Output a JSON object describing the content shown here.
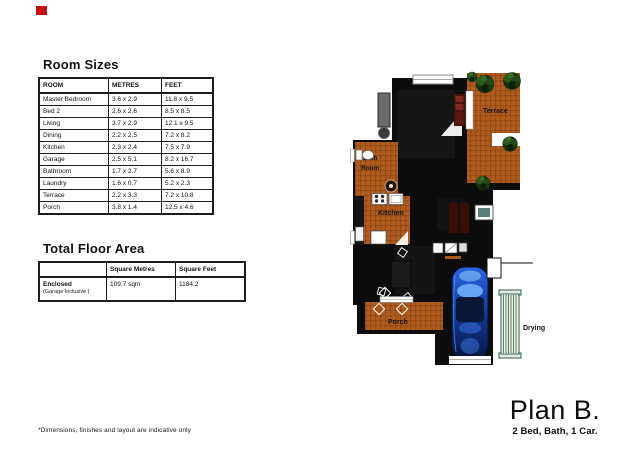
{
  "page": {
    "red_mark_color": "#c41010"
  },
  "room_sizes": {
    "title": "Room Sizes",
    "headers": [
      "ROOM",
      "METRES",
      "FEET"
    ],
    "rows": [
      [
        "Master Bedroom",
        "3.6 x 2.9",
        "11.8 x 9.5"
      ],
      [
        "Bed 2",
        "2.6 x 2.6",
        "8.5 x 8.5"
      ],
      [
        "Living",
        "3.7 x 2.9",
        "12.1 x 9.5"
      ],
      [
        "Dining",
        "2.2 x 2.5",
        "7.2 x 8.2"
      ],
      [
        "Kitchen",
        "2.3 x 2.4",
        "7.5 x 7.9"
      ],
      [
        "Garage",
        "2.5 x 5.1",
        "8.2 x 16.7"
      ],
      [
        "Bathroom",
        "1.7 x 2.7",
        "5.6 x 8.9"
      ],
      [
        "Laundry",
        "1.6 x 0.7",
        "5.2 x 2.3"
      ],
      [
        "Terrace",
        "2.2 x 3.3",
        "7.2 x 10.8"
      ],
      [
        "Porch",
        "3.8 x 1.4",
        "12.5 x 4.6"
      ]
    ]
  },
  "total_floor_area": {
    "title": "Total Floor Area",
    "headers": [
      "",
      "Square Metres",
      "Square Feet"
    ],
    "row": {
      "label": "Enclosed",
      "sublabel": "(Garage Inclusive )",
      "square_metres": "109.7 sqm",
      "square_feet": "1184.2"
    }
  },
  "floor_plan": {
    "labels": {
      "terrace": "Terrace",
      "bath_line1": "Bath",
      "bath_line2": "Room",
      "kitchen": "Kitchen",
      "porch": "Porch",
      "drying": "Drying"
    },
    "colors": {
      "tile": "#b05c1e",
      "tile_grout": "#7c3a0e",
      "building": "#0c0c0c",
      "car_blue": "#1e56d8",
      "bush_green": "#16300f",
      "drying_rack_green": "#2e5e3e",
      "bed_maroon": "#4a120d"
    }
  },
  "plan_label": {
    "title": "Plan B.",
    "subtitle": "2 Bed, Bath, 1 Car."
  },
  "footnote": "*Dimensions, finishes and layout are indicative only"
}
